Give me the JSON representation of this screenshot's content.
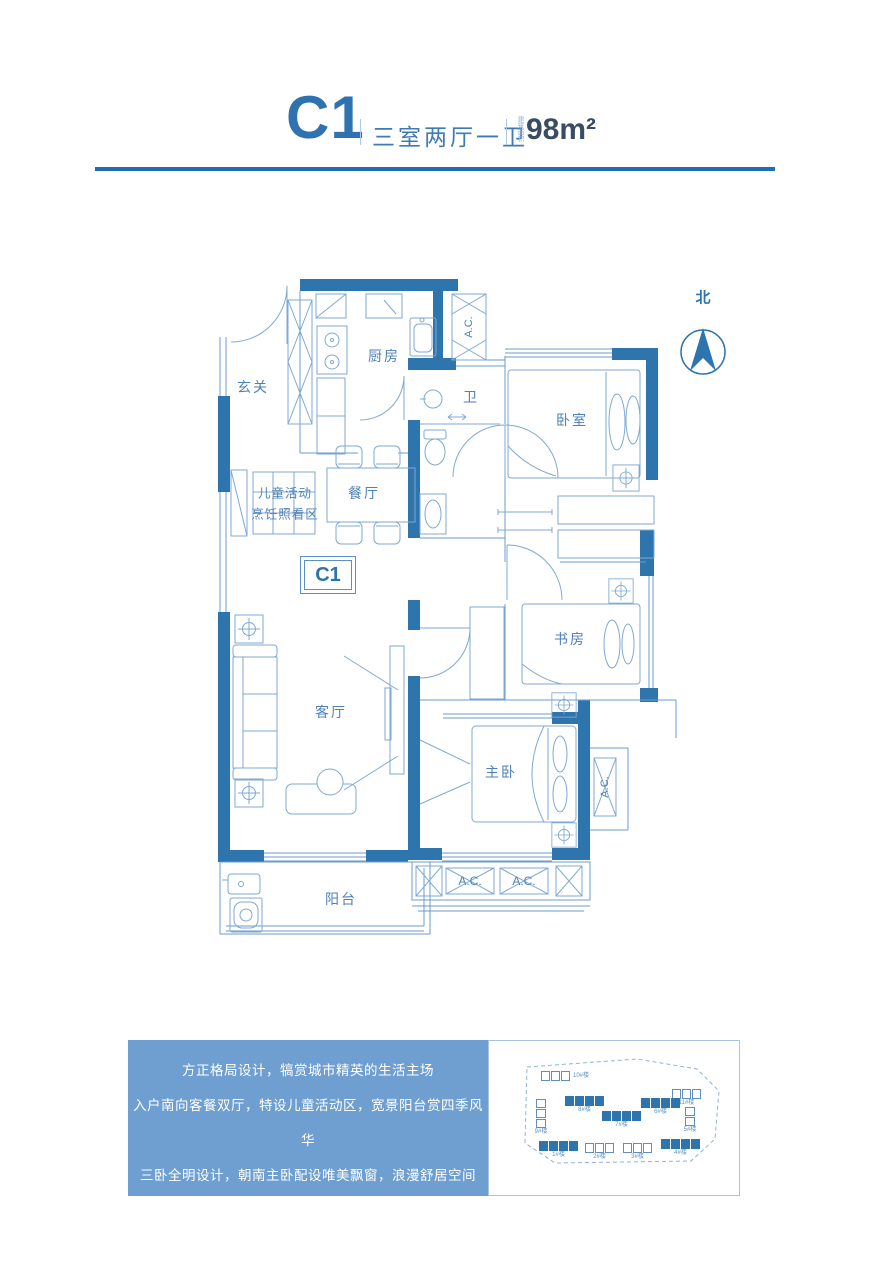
{
  "header": {
    "unit_code": "C1",
    "layout": "三室两厅一卫",
    "area_label": "建筑面积",
    "area_value": "98m²"
  },
  "plan": {
    "north_label": "北",
    "unit_box_label": "C1",
    "ac_label": "A.C.",
    "rooms": {
      "entry": "玄关",
      "kitchen": "厨房",
      "bath": "卫",
      "bedroom": "卧室",
      "dining": "餐厅",
      "kids_line1": "儿童活动",
      "kids_line2": "烹饪照看区",
      "study": "书房",
      "living": "客厅",
      "master": "主卧",
      "balcony": "阳台"
    }
  },
  "description": {
    "lines": [
      "方正格局设计，犒赏城市精英的生活主场",
      "入户南向客餐双厅，特设儿童活动区，宽景阳台赏四季风华",
      "三卧全明设计，朝南主卧配设唯美飘窗，浪漫舒居空间",
      "厨卫合理搭配，干湿分离卫浴室，动静相宜格局设计"
    ]
  },
  "siteplan": {
    "buildings": [
      {
        "label": "10#楼",
        "x": 52,
        "y": 30,
        "units": 3,
        "filled": false,
        "labelpos": "right"
      },
      {
        "label": "11#楼",
        "x": 183,
        "y": 48,
        "units": 3,
        "filled": false,
        "labelpos": "below"
      },
      {
        "label": "9#楼",
        "x": 47,
        "y": 58,
        "units": 3,
        "filled": false,
        "vertical": true,
        "labelpos": "below"
      },
      {
        "label": "8#楼",
        "x": 76,
        "y": 55,
        "units": 4,
        "filled": true,
        "labelpos": "below"
      },
      {
        "label": "7#楼",
        "x": 113,
        "y": 70,
        "units": 4,
        "filled": true,
        "labelpos": "below"
      },
      {
        "label": "6#楼",
        "x": 152,
        "y": 57,
        "units": 4,
        "filled": true,
        "labelpos": "below"
      },
      {
        "label": "5#楼",
        "x": 196,
        "y": 66,
        "units": 2,
        "filled": false,
        "vertical": true,
        "labelpos": "below"
      },
      {
        "label": "1#楼",
        "x": 50,
        "y": 100,
        "units": 4,
        "filled": true,
        "labelpos": "below"
      },
      {
        "label": "2#楼",
        "x": 96,
        "y": 102,
        "units": 3,
        "filled": false,
        "labelpos": "below"
      },
      {
        "label": "3#楼",
        "x": 134,
        "y": 102,
        "units": 3,
        "filled": false,
        "labelpos": "below"
      },
      {
        "label": "4#楼",
        "x": 172,
        "y": 98,
        "units": 4,
        "filled": true,
        "labelpos": "below"
      }
    ]
  },
  "colors": {
    "wall_blue": "#2E74AD",
    "line_blue": "#6C9CCB",
    "accent_rule": "#1E6FB6",
    "panel_blue": "#6E9FD0"
  }
}
